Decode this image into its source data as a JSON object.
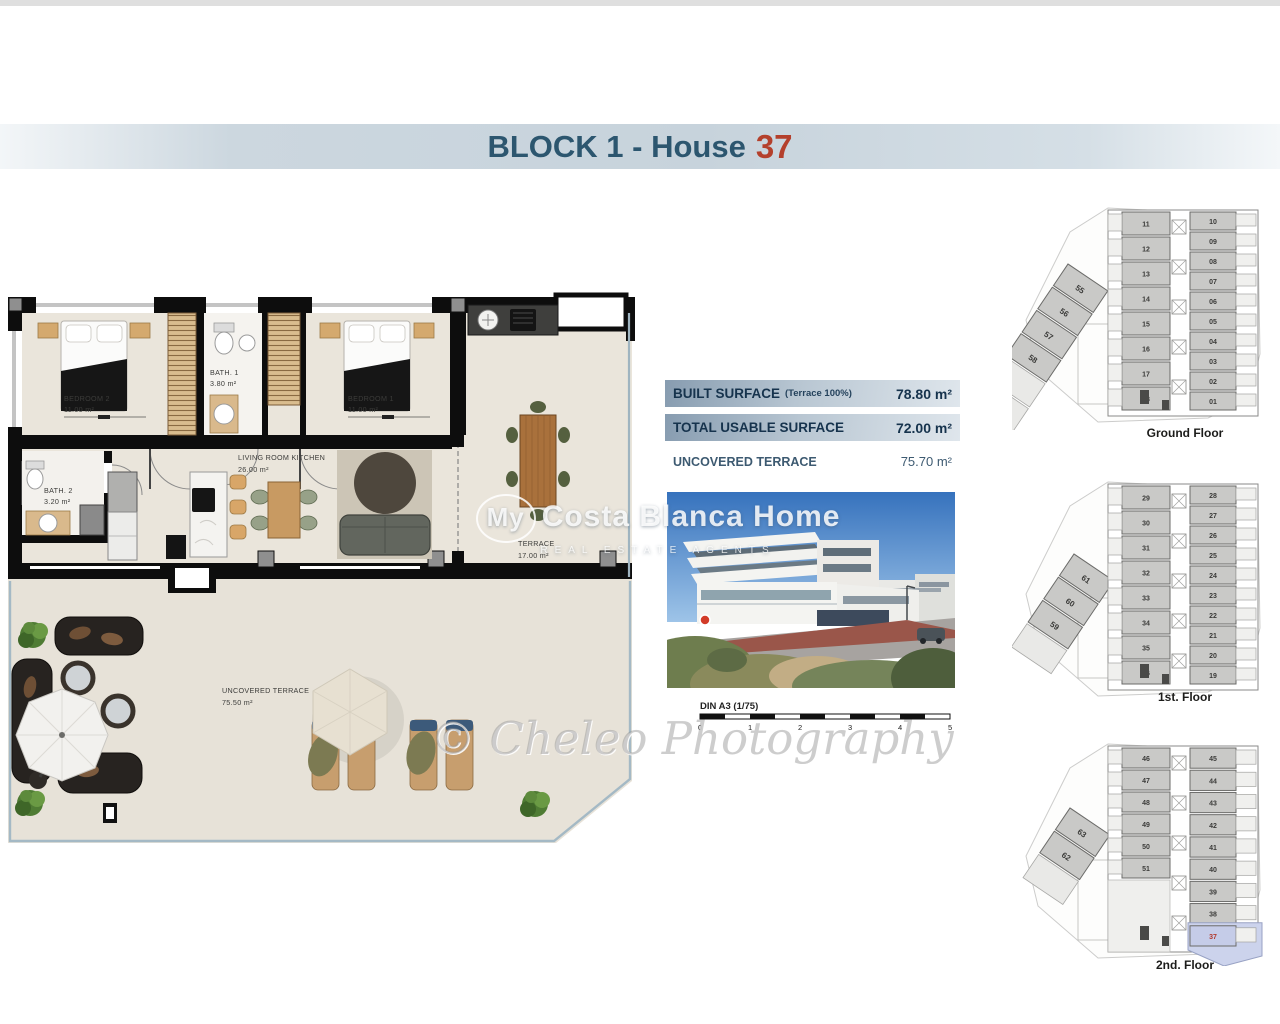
{
  "title": {
    "block": "BLOCK 1 - House",
    "house_number": "37"
  },
  "surface_table": {
    "rows": [
      {
        "label": "BUILT SURFACE",
        "note": "(Terrace 100%)",
        "value": "78.80 m²"
      },
      {
        "label": "TOTAL USABLE SURFACE",
        "note": "",
        "value": "72.00 m²"
      },
      {
        "label": "UNCOVERED TERRACE",
        "note": "",
        "value": "75.70 m²"
      }
    ]
  },
  "floorplan": {
    "rooms": [
      {
        "name": "BEDROOM 2",
        "area": "11.00 m²"
      },
      {
        "name": "BATH. 1",
        "area": "3.80 m²"
      },
      {
        "name": "BEDROOM 1",
        "area": "11.00 m²"
      },
      {
        "name": "LIVING ROOM KITCHEN",
        "area": "26.00 m²"
      },
      {
        "name": "BATH. 2",
        "area": "3.20 m²"
      },
      {
        "name": "TERRACE",
        "area": "17.00 m²"
      },
      {
        "name": "UNCOVERED TERRACE",
        "area": "75.50 m²"
      }
    ]
  },
  "scale_bar": {
    "label": "DIN A3 (1/75)",
    "ticks": [
      "0",
      "1",
      "2",
      "3",
      "4",
      "5"
    ]
  },
  "watermarks": {
    "brand_prefix": "My",
    "brand_rest": "Costa Blanca Home",
    "brand_sub": "REAL ESTATE AGENTS",
    "photo_credit": "© Cheleo Photography"
  },
  "mini_floors": [
    {
      "label": "Ground Floor",
      "left_units": [
        "11",
        "12",
        "13",
        "14",
        "15",
        "16",
        "17",
        "18"
      ],
      "right_units": [
        "10",
        "09",
        "08",
        "07",
        "06",
        "05",
        "04",
        "03",
        "02",
        "01"
      ],
      "diagonal_units": [
        "55",
        "56",
        "57",
        "58"
      ],
      "highlight": ""
    },
    {
      "label": "1st. Floor",
      "left_units": [
        "29",
        "30",
        "31",
        "32",
        "33",
        "34",
        "35",
        "36"
      ],
      "right_units": [
        "28",
        "27",
        "26",
        "25",
        "24",
        "23",
        "22",
        "21",
        "20",
        "19"
      ],
      "diagonal_units": [
        "61",
        "60",
        "59"
      ],
      "highlight": ""
    },
    {
      "label": "2nd. Floor",
      "left_units": [
        "46",
        "47",
        "48",
        "49",
        "50",
        "51"
      ],
      "right_units": [
        "45",
        "44",
        "43",
        "42",
        "41",
        "40",
        "39",
        "38",
        "37"
      ],
      "diagonal_units": [
        "63",
        "62"
      ],
      "highlight": "37"
    }
  ],
  "colors": {
    "title_text": "#2c566f",
    "title_number": "#b4402c",
    "table_bar": "#8fa3b6",
    "highlight_unit": "#ccd3ec",
    "highlight_number": "#b23a2e",
    "wall": "#0d0d0d",
    "floor": "#eae5db"
  }
}
